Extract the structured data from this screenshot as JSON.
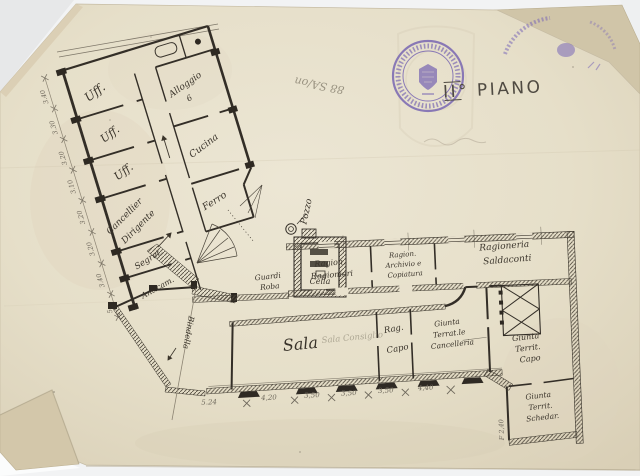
{
  "header": {
    "floor_label": "II° PIANO",
    "archive_note": "88 SA/on"
  },
  "colors": {
    "paper": "#e8e1cd",
    "ink": "#39332a",
    "pencil": "#87806f",
    "stamp": "#6f5cb0"
  },
  "left_wing": {
    "west_rooms": [
      "Uff.",
      "Uff.",
      "Uff."
    ],
    "cancelliere": [
      "Cancellier",
      "Dirigente"
    ],
    "segreteria": "Segret.",
    "anticamera": "Anticam.",
    "alloggio": [
      "Alloggio",
      "6"
    ],
    "cucina": "Cucina",
    "ferro": "Ferro",
    "dims": [
      "3.40",
      "3.30",
      "3.20",
      "3.10",
      "3.20",
      "3.20",
      "3.40",
      "5.-"
    ]
  },
  "center": {
    "pozzo": "Pozzo",
    "guardaroba": [
      "Guardi",
      "Roba"
    ],
    "cella": "Cella",
    "bindella": "Bindella"
  },
  "right_wing": {
    "ragionieri": [
      "Ragion.",
      "Ragionieri"
    ],
    "archivio": [
      "Ragion.",
      "Archivio e",
      "Copiatura"
    ],
    "saldaconti": [
      "Ragioneria",
      "Saldaconti"
    ],
    "sala": "Sala",
    "sala_faint": "Sala Consiglio",
    "rag_capo": [
      "Rag.",
      "Capo"
    ],
    "giunta_cancelleria": [
      "Giunta",
      "Terrat.le",
      "Cancelleria"
    ],
    "giunta_capo": [
      "Giunta",
      "Territ.",
      "Capo"
    ],
    "giunta_schedario": [
      "Giunta",
      "Territ.",
      "Schedar."
    ],
    "dims_bottom": [
      "5.24",
      "4,20",
      "3,50",
      "3,50",
      "3,50",
      "4,40"
    ],
    "dim_right": "F 2,40"
  }
}
